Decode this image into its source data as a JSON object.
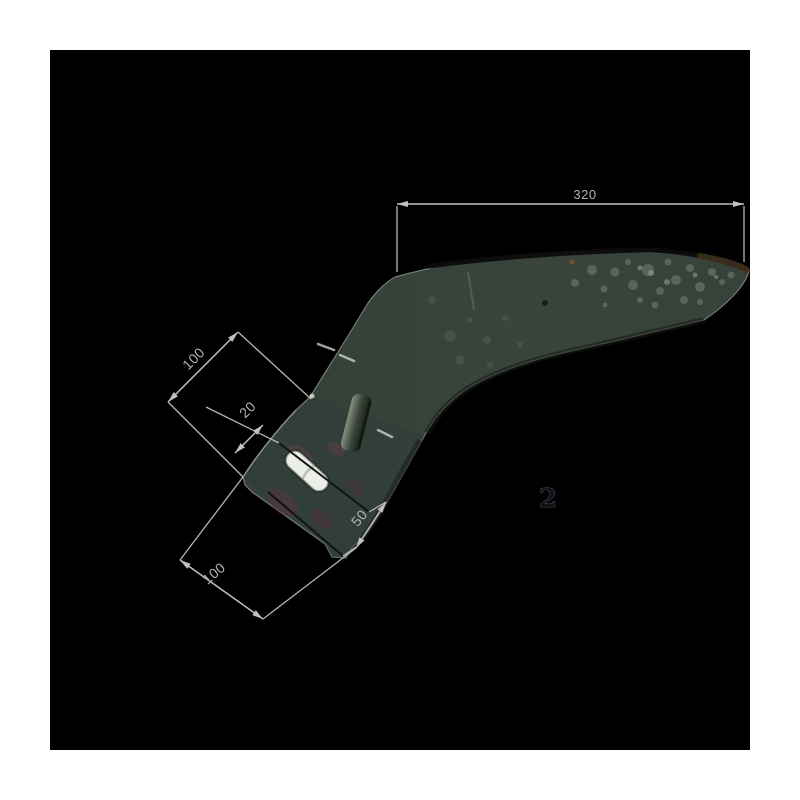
{
  "image": {
    "description": "dimensioned product photo of curved cultivator sweep blade",
    "part_label": "2",
    "dimension_labels": {
      "top": "320",
      "upper_left": "100",
      "inner": "20",
      "lower_right": "50",
      "lower_left": "100"
    }
  },
  "colors": {
    "page_bg": "#ffffff",
    "frame_bg": "#000000",
    "dim_line": "#c0c0c0",
    "dim_text": "#b2b2b2",
    "blade_base": "#39443b",
    "blade_edge_dark": "#0b0b0b",
    "blade_mottle": "#7d8878",
    "shank_tint": "#2e3c3c",
    "rust_patch": "#63404b",
    "slot_fill": "#ebeee8",
    "part_label_color": "#11111a"
  }
}
